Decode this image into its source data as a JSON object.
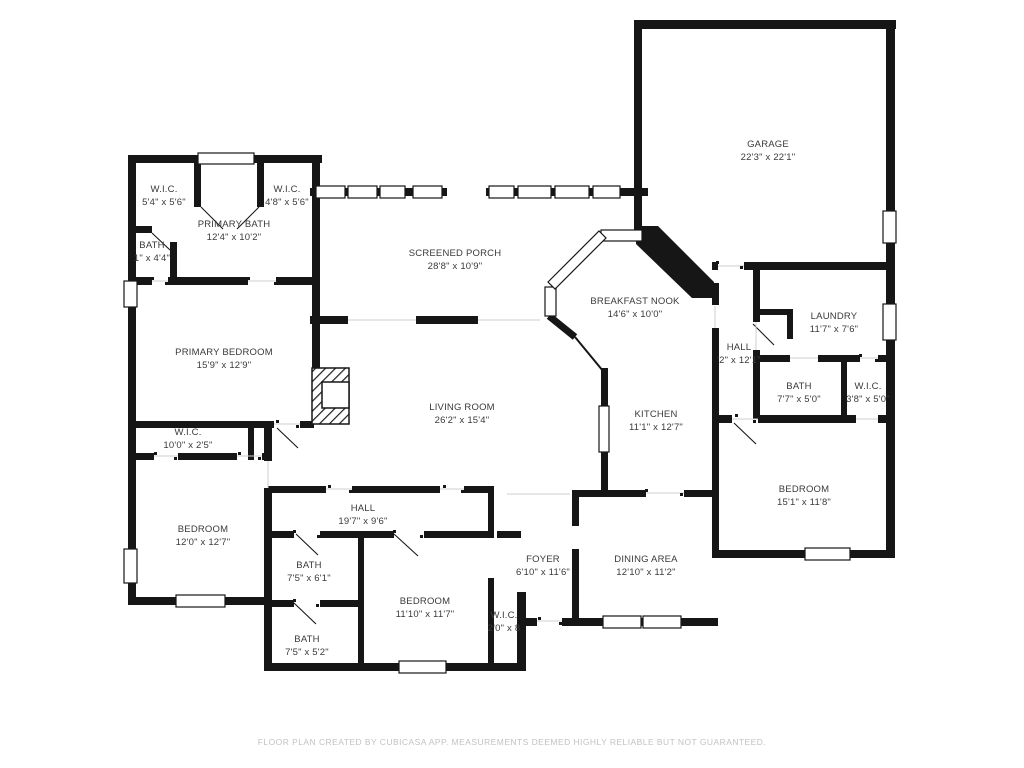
{
  "footer": {
    "text": "FLOOR PLAN CREATED BY CUBICASA APP. MEASUREMENTS DEEMED HIGHLY RELIABLE BUT NOT GUARANTEED."
  },
  "colors": {
    "wall": "#161616",
    "label_text": "#3a3a3a",
    "footer_text": "#c2c2c2",
    "background": "#ffffff"
  },
  "rooms": [
    {
      "id": "wic-nw",
      "name": "W.I.C.",
      "dims": "5'4\" x 5'6\""
    },
    {
      "id": "wic-ne",
      "name": "W.I.C.",
      "dims": "4'8\" x 5'6\""
    },
    {
      "id": "primary-bath",
      "name": "PRIMARY BATH",
      "dims": "12'4\" x 10'2\""
    },
    {
      "id": "bath-nw",
      "name": "BATH",
      "dims": "1\" x 4'4\""
    },
    {
      "id": "screened-porch",
      "name": "SCREENED PORCH",
      "dims": "28'8\" x 10'9\""
    },
    {
      "id": "garage",
      "name": "GARAGE",
      "dims": "22'3\" x 22'1\""
    },
    {
      "id": "breakfast-nook",
      "name": "BREAKFAST NOOK",
      "dims": "14'6\" x 10'0\""
    },
    {
      "id": "hall-right",
      "name": "HALL",
      "dims": "'2\" x 12'1\""
    },
    {
      "id": "laundry",
      "name": "LAUNDRY",
      "dims": "11'7\" x 7'6\""
    },
    {
      "id": "bath-right",
      "name": "BATH",
      "dims": "7'7\" x 5'0\""
    },
    {
      "id": "wic-right",
      "name": "W.I.C.",
      "dims": "3'8\" x 5'0\""
    },
    {
      "id": "primary-bedroom",
      "name": "PRIMARY BEDROOM",
      "dims": "15'9\" x 12'9\""
    },
    {
      "id": "wic-strip",
      "name": "W.I.C.",
      "dims": "10'0\" x 2'5\""
    },
    {
      "id": "living-room",
      "name": "LIVING ROOM",
      "dims": "26'2\" x 15'4\""
    },
    {
      "id": "kitchen",
      "name": "KITCHEN",
      "dims": "11'1\" x 12'7\""
    },
    {
      "id": "bedroom-left",
      "name": "BEDROOM",
      "dims": "12'0\" x 12'7\""
    },
    {
      "id": "hall-main",
      "name": "HALL",
      "dims": "19'7\" x 9'6\""
    },
    {
      "id": "bath-hall",
      "name": "BATH",
      "dims": "7'5\" x 6'1\""
    },
    {
      "id": "bedroom-mid",
      "name": "BEDROOM",
      "dims": "11'10\" x 11'7\""
    },
    {
      "id": "bath-bottom",
      "name": "BATH",
      "dims": "7'5\" x 5'2\""
    },
    {
      "id": "wic-bottom",
      "name": "W.I.C.",
      "dims": "2'0\" x 8"
    },
    {
      "id": "foyer",
      "name": "FOYER",
      "dims": "6'10\" x 11'6\""
    },
    {
      "id": "dining-area",
      "name": "DINING AREA",
      "dims": "12'10\" x 11'2\""
    },
    {
      "id": "bedroom-right",
      "name": "BEDROOM",
      "dims": "15'1\" x 11'8\""
    }
  ]
}
